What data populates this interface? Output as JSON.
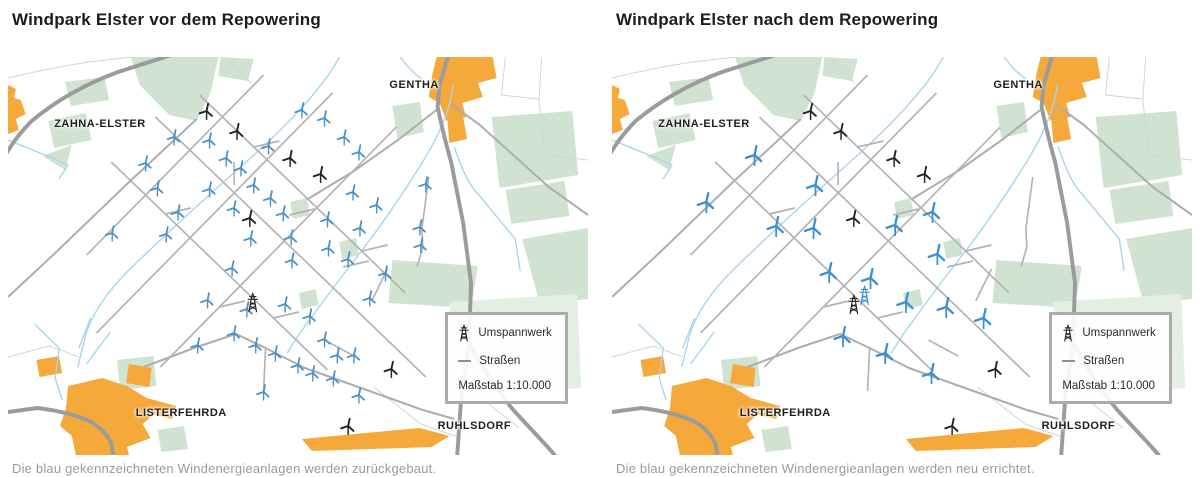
{
  "page": {
    "background": "#ffffff"
  },
  "colors": {
    "forest": "#cfe3d0",
    "forest_light": "#e4efe3",
    "town": "#f4a93a",
    "water": "#a8d4ee",
    "road_main": "#9b9b9b",
    "road_medium": "#adadad",
    "road_grid": "#b3b3b3",
    "road_thin": "#d4d4d4",
    "turbine_existing_blue": "#4a90c8",
    "turbine_new_blue": "#3d8fd2",
    "turbine_black": "#222222",
    "label_text": "#1d1d1b",
    "caption_text": "#959c9d",
    "legend_border": "#ababab"
  },
  "icons": {
    "turbine": "wind-turbine-icon",
    "substation": "power-pylon-icon",
    "road": "road-line-icon"
  },
  "legend": {
    "umspannwerk": "Umspannwerk",
    "strassen": "Straßen",
    "massstab": "Maßstab 1:10.000"
  },
  "map_labels": [
    {
      "text": "ZAHNA-ELSTER",
      "x": 47,
      "y": 61
    },
    {
      "text": "GENTHA",
      "x": 388,
      "y": 22
    },
    {
      "text": "LISTERFEHRDA",
      "x": 130,
      "y": 350
    },
    {
      "text": "RUHLSDORF",
      "x": 437,
      "y": 363
    }
  ],
  "panels": [
    {
      "title": "Windpark Elster vor dem Repowering",
      "caption": "Die blau gekennzeichneten Windenergieanlagen werden zurückgebaut.",
      "blue_scale": 1,
      "turbines_blue": [
        [
          169,
          80
        ],
        [
          205,
          83
        ],
        [
          299,
          53
        ],
        [
          322,
          61
        ],
        [
          140,
          106
        ],
        [
          222,
          101
        ],
        [
          237,
          111
        ],
        [
          265,
          89
        ],
        [
          342,
          80
        ],
        [
          357,
          95
        ],
        [
          152,
          131
        ],
        [
          205,
          132
        ],
        [
          250,
          128
        ],
        [
          267,
          141
        ],
        [
          173,
          155
        ],
        [
          230,
          151
        ],
        [
          280,
          156
        ],
        [
          161,
          177
        ],
        [
          247,
          181
        ],
        [
          288,
          180
        ],
        [
          325,
          162
        ],
        [
          351,
          135
        ],
        [
          375,
          148
        ],
        [
          358,
          171
        ],
        [
          326,
          191
        ],
        [
          346,
          202
        ],
        [
          289,
          203
        ],
        [
          228,
          211
        ],
        [
          106,
          176
        ],
        [
          425,
          127
        ],
        [
          419,
          170
        ],
        [
          420,
          188
        ],
        [
          193,
          288
        ],
        [
          230,
          276
        ],
        [
          252,
          288
        ],
        [
          272,
          296
        ],
        [
          295,
          308
        ],
        [
          310,
          316
        ],
        [
          331,
          321
        ],
        [
          260,
          335
        ],
        [
          357,
          338
        ],
        [
          322,
          282
        ],
        [
          335,
          298
        ],
        [
          352,
          298
        ],
        [
          203,
          243
        ],
        [
          243,
          252
        ],
        [
          282,
          247
        ],
        [
          307,
          259
        ],
        [
          384,
          216
        ],
        [
          368,
          241
        ]
      ],
      "turbines_black": [
        [
          202,
          54
        ],
        [
          233,
          74
        ],
        [
          287,
          101
        ],
        [
          318,
          117
        ],
        [
          246,
          161
        ],
        [
          390,
          312
        ],
        [
          346,
          369
        ]
      ],
      "substations": [
        {
          "x": 249,
          "y": 246,
          "color": "black"
        }
      ]
    },
    {
      "title": "Windpark Elster nach dem Repowering",
      "caption": "Die blau gekennzeichneten Windenergieanlagen werden neu errichtet.",
      "blue_scale": 1.3,
      "turbines_blue": [
        [
          145,
          98
        ],
        [
          207,
          128
        ],
        [
          96,
          145
        ],
        [
          167,
          169
        ],
        [
          205,
          171
        ],
        [
          326,
          155
        ],
        [
          288,
          168
        ],
        [
          221,
          215
        ],
        [
          263,
          221
        ],
        [
          331,
          197
        ],
        [
          299,
          245
        ],
        [
          340,
          250
        ],
        [
          378,
          261
        ],
        [
          235,
          279
        ],
        [
          278,
          296
        ],
        [
          325,
          316
        ]
      ],
      "turbines_black": [
        [
          202,
          54
        ],
        [
          233,
          74
        ],
        [
          287,
          101
        ],
        [
          318,
          117
        ],
        [
          246,
          161
        ],
        [
          390,
          312
        ],
        [
          346,
          369
        ]
      ],
      "substations": [
        {
          "x": 246,
          "y": 248,
          "color": "black"
        },
        {
          "x": 257,
          "y": 239,
          "color": "blue"
        }
      ]
    }
  ]
}
